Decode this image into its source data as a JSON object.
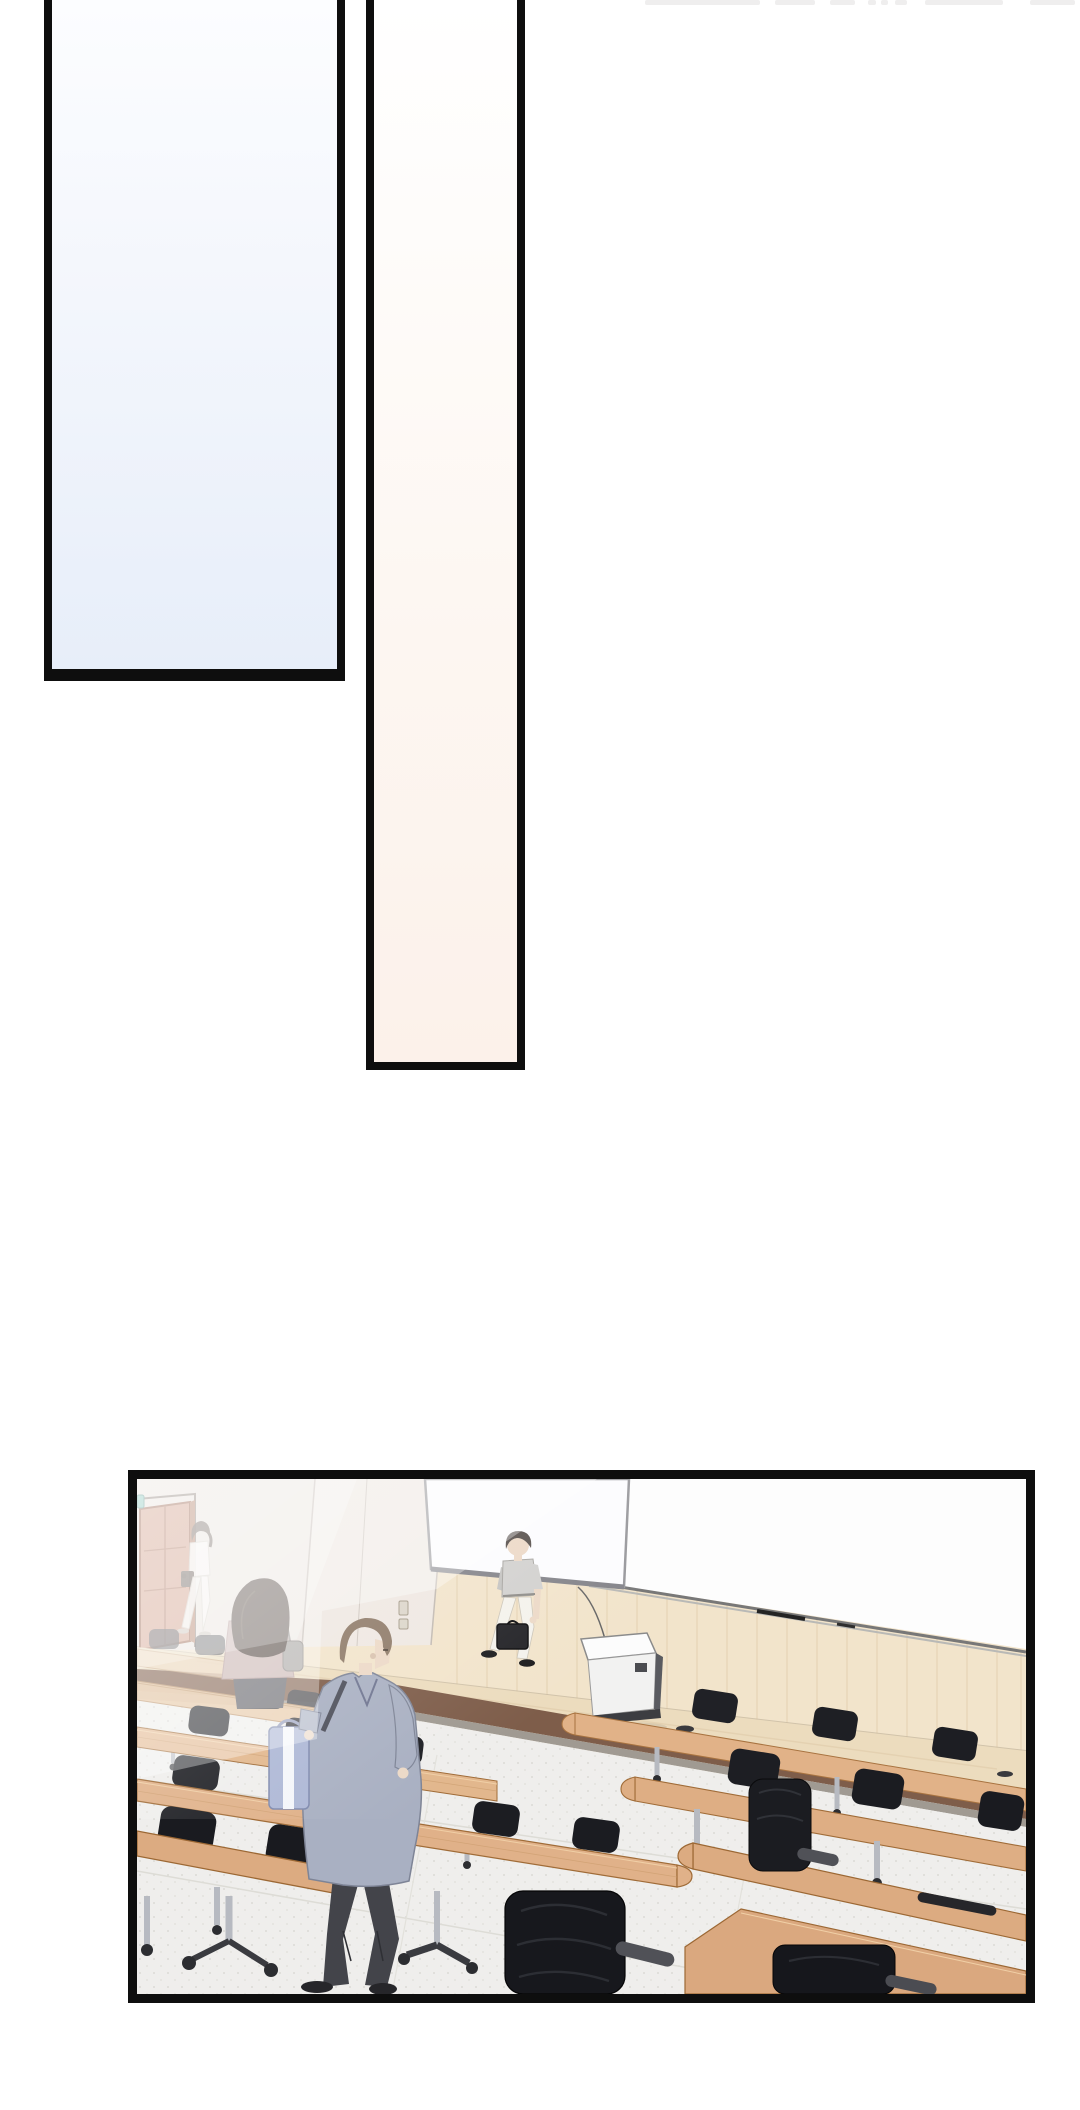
{
  "page": {
    "kind": "webtoon comic page",
    "width": 1080,
    "height": 2110,
    "text_content": "none (wordless panels)"
  },
  "panels": [
    {
      "id": "panel-blue",
      "label": "tall empty panel with pale blue gradient, cut off at top edge"
    },
    {
      "id": "panel-peach",
      "label": "narrow tall empty panel with pale peach gradient, cut off at top edge"
    },
    {
      "id": "panel-hall",
      "label": "wide panel: empty university lecture hall seen from the seats"
    }
  ],
  "scene": {
    "setting": "lecture hall with stage, whiteboard, projection screen, podium, rows of wooden desks and black office chairs",
    "objects": [
      "wood panel wall",
      "large whiteboard with marker tray",
      "hanging projection screen",
      "brown door at far left with small teal sign",
      "light switch panel",
      "stage platform with brown front edge",
      "white lectern podium with cable",
      "speckled gray floor",
      "floor cable outlets",
      "rows of light wood desks",
      "black mesh office chairs on casters",
      "silver desk legs"
    ],
    "people": [
      "woman in white walking out of the door carrying a dark bag (background, hazy)",
      "seated woman with dark brown hair, mauve top and gray bag, facing away",
      "man in light gray shirt and cream pants crossing the stage carrying a black briefcase",
      "foreground man in blue-gray coat and dark trousers walking right, carrying a periwinkle striped tote bag"
    ],
    "atmosphere": "soft white haze over the left/background side of the room"
  },
  "colors": {
    "bg_white": "#ffffff",
    "artifact": "#efeeee",
    "border": "#0e0e0e",
    "panel1_top": "#fcfdff",
    "panel1_bottom": "#e7eef9",
    "panel2_top": "#ffffff",
    "panel2_bottom": "#fcf1ea",
    "wall_wood": "#f2e4cb",
    "wall_grain": "#e3cfae",
    "wall_pale": "#eae2dd",
    "wall_pale2": "#efe8e2",
    "board": "#fdfdfd",
    "screen": "#fcfcfe",
    "door": "#cf9b84",
    "door_stroke": "#97604a",
    "exit_plate": "#86c5bb",
    "stage_top": "#ecdcbe",
    "stage_front": "#7e5d4a",
    "stage_skirt": "#a09a92",
    "floor": "#efeeec",
    "desk_light": "#e6c29b",
    "desk": "#e0b189",
    "desk_dark": "#dcab81",
    "desk_stroke": "#a06c38",
    "chair": "#1b1c21",
    "chair_light": "#303238",
    "armrest": "#505157",
    "leg": "#b7bac1",
    "caster": "#2c2d31",
    "skin": "#ecd9c7",
    "shirt_gray": "#d2d1cf",
    "pants_cream": "#f4f2ec",
    "briefcase": "#232327",
    "hair_dark": "#57504c",
    "hair_brown": "#524741",
    "hair_man": "#8f7b69",
    "woman_top": "#c9b3b1",
    "woman_skirt": "#5c5b61",
    "woman_bag": "#a8a4a2",
    "coat": "#a9b0c2",
    "coat_line": "#7e8496",
    "strap": "#4d4f5a",
    "pants": "#43444a",
    "shoe": "#26262a",
    "tote": "#aeb8d6",
    "tote_stripe": "#f4f6fa"
  }
}
